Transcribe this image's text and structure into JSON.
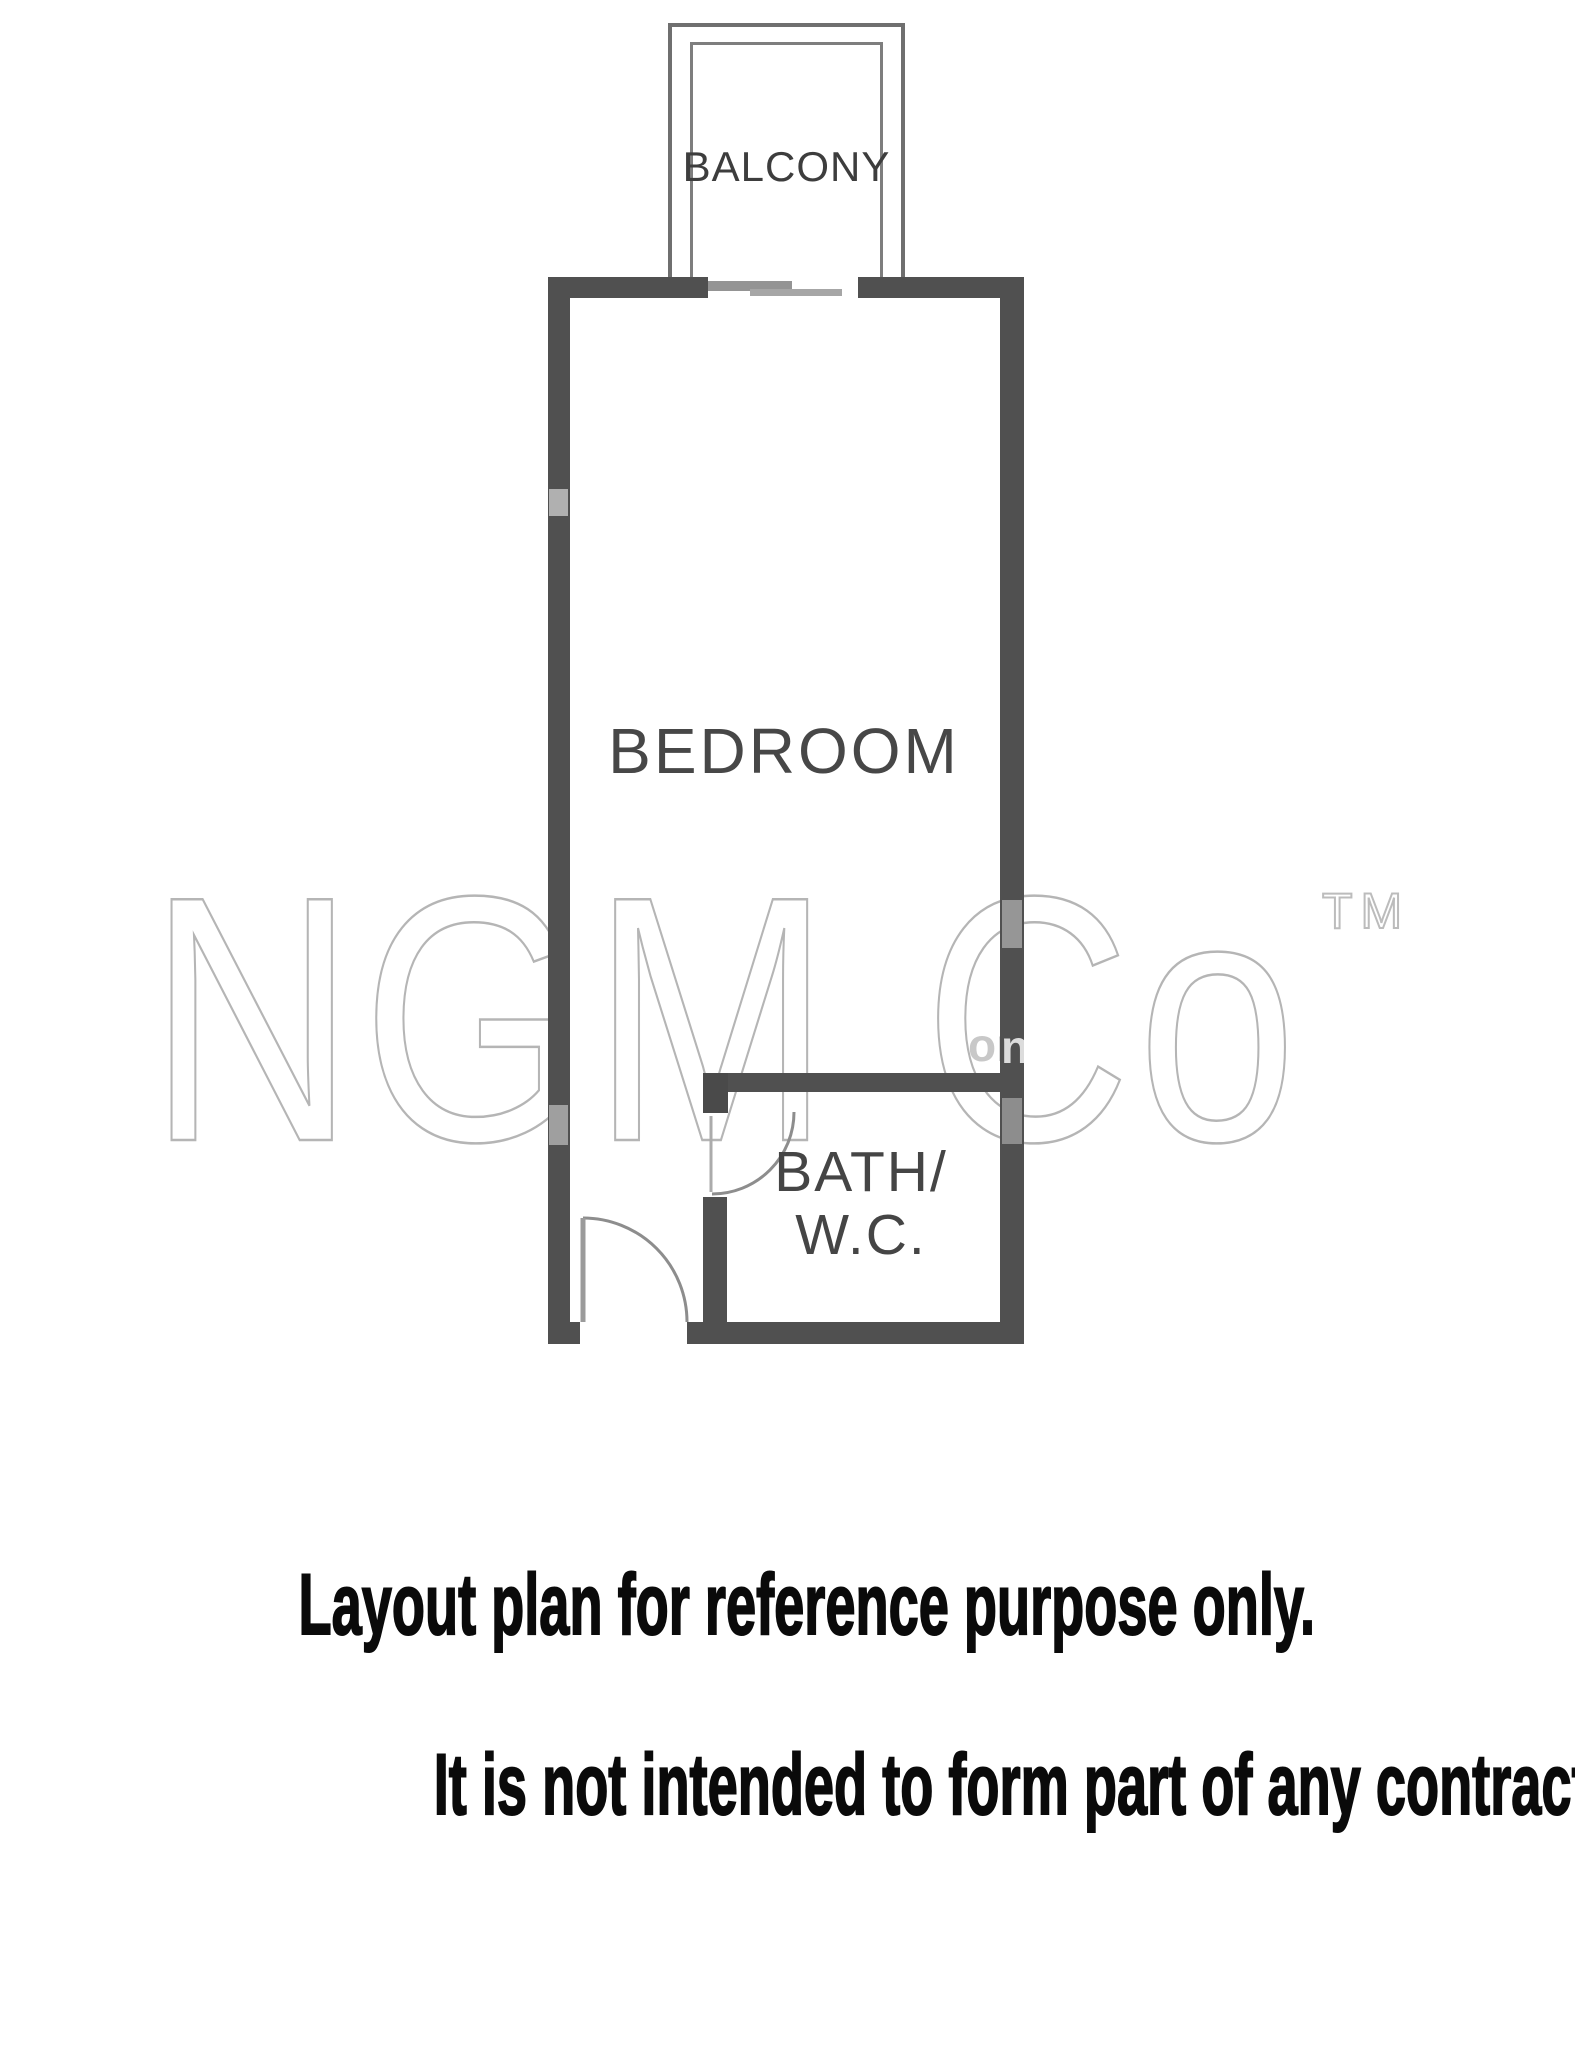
{
  "floorplan": {
    "rooms": {
      "balcony": {
        "label": "BALCONY"
      },
      "bedroom": {
        "label": "BEDROOM"
      },
      "bath": {
        "label_line1": "BATH/",
        "label_line2": "W.C."
      }
    },
    "watermark": {
      "brand": "NGM Co",
      "trademark": "TM",
      "overlay_fragment_left": "or",
      "overlay_fragment_right": "n"
    },
    "colors": {
      "wall": "#505050",
      "balcony_outline": "#6f6f6f",
      "door_arc": "#8d8d8d",
      "label_text": "#454545",
      "watermark_outline": "#b5b5b5",
      "footer_text": "#0a0a0a"
    }
  },
  "footer": {
    "line1": "Layout plan for reference purpose only.",
    "line2": "It is not intended to form part of any contract or warranty."
  }
}
